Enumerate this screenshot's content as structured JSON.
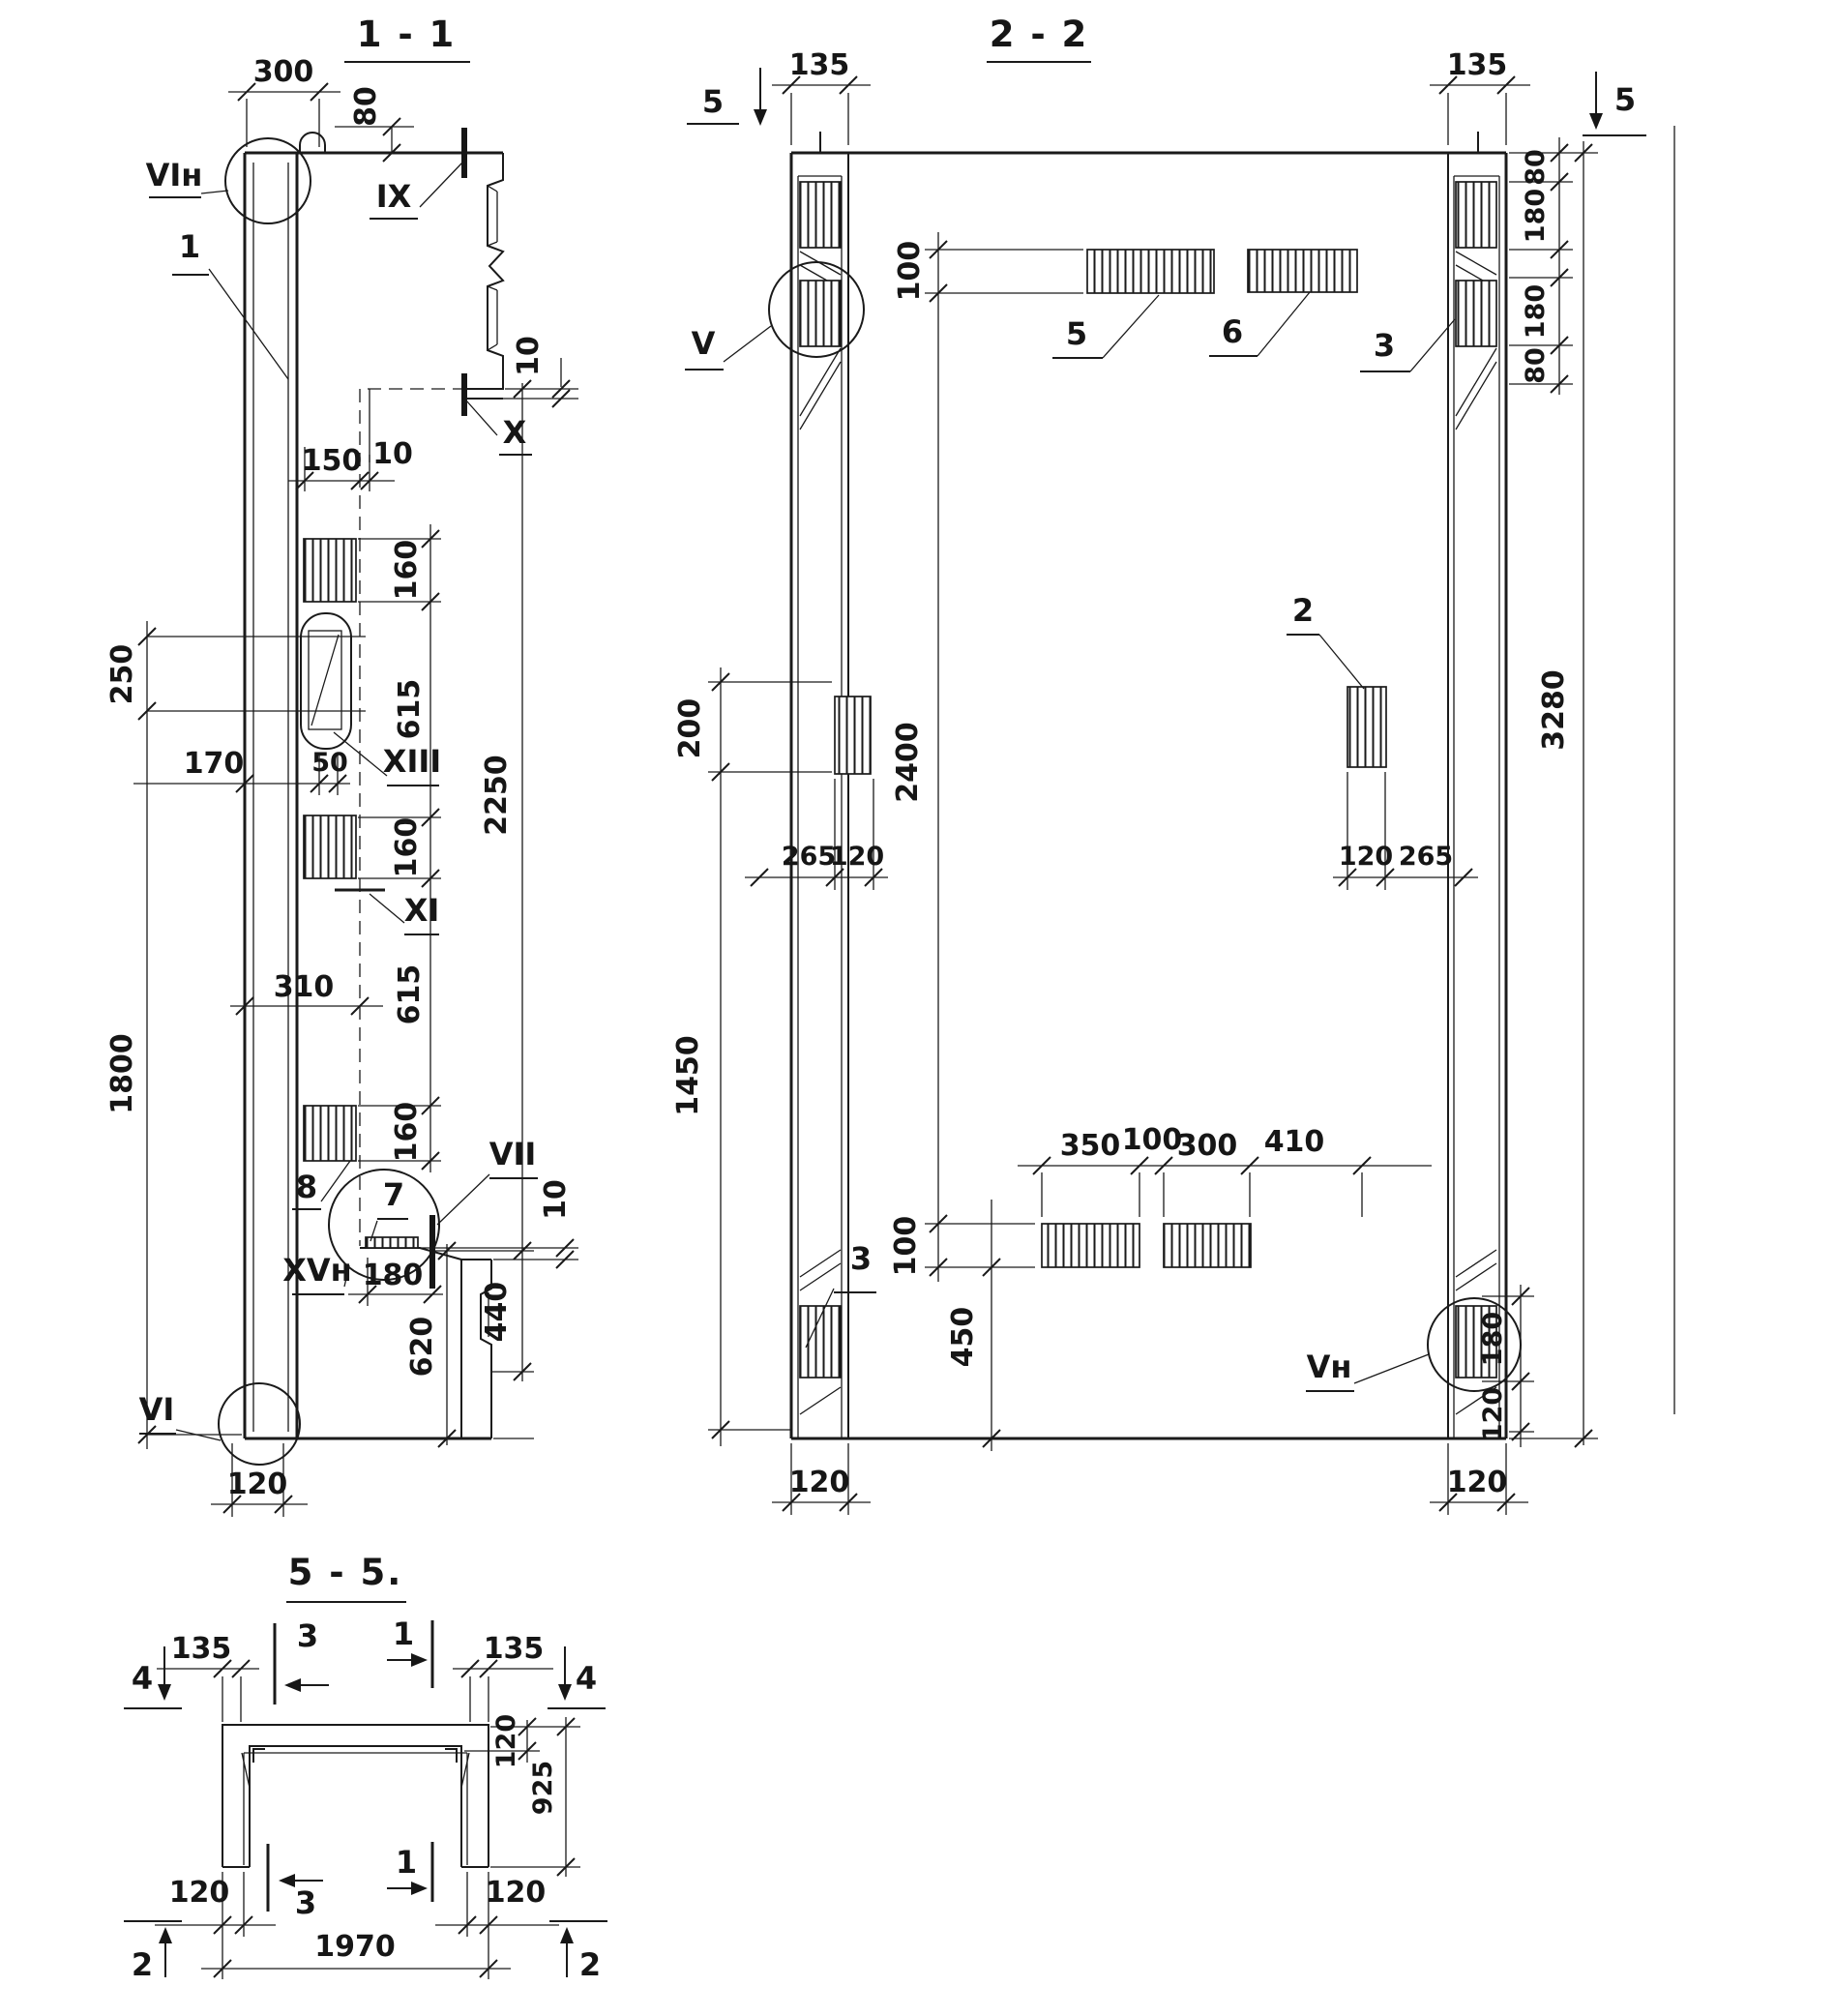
{
  "s11": {
    "title": "1 - 1",
    "dim_300": "300",
    "dim_80": "80",
    "dim_10_top": "10",
    "dim_150": "150",
    "dim_10_mid": "10",
    "dim_160_a": "160",
    "dim_615_a": "615",
    "dim_160_b": "160",
    "dim_615_b": "615",
    "dim_160_c": "160",
    "dim_2250": "2250",
    "dim_440": "440",
    "dim_620": "620",
    "dim_250": "250",
    "dim_1800": "1800",
    "dim_170": "170",
    "dim_50": "50",
    "dim_310": "310",
    "dim_180": "180",
    "dim_10_bottom": "10",
    "dim_120": "120",
    "label_vi_n": "VIн",
    "label_1": "1",
    "label_ix": "IX",
    "label_x": "X",
    "label_xiii": "XIII",
    "label_xi": "XI",
    "label_8": "8",
    "label_7": "7",
    "label_vii": "VII",
    "label_xv_n": "XVн",
    "label_vi": "VI"
  },
  "s22": {
    "title": "2 - 2",
    "marker_5_left": "5",
    "marker_5_right": "5",
    "dim_135_left": "135",
    "dim_135_right": "135",
    "dim_100_top": "100",
    "dim_2400": "2400",
    "dim_100_bottom": "100",
    "dim_450": "450",
    "dim_200": "200",
    "dim_1450": "1450",
    "dim_265_left": "265",
    "dim_120_left_mid": "120",
    "dim_120_right_mid": "120",
    "dim_265_right": "265",
    "dim_350": "350",
    "dim_100_bars": "100",
    "dim_300": "300",
    "dim_410": "410",
    "dim_80_a": "80",
    "dim_180_a": "180",
    "dim_180_b": "180",
    "dim_80_b": "80",
    "dim_3280": "3280",
    "dim_180_right": "180",
    "dim_120_right": "120",
    "dim_120_col_left": "120",
    "dim_120_col_right": "120",
    "label_v": "V",
    "label_v_n": "Vн",
    "label_2": "2",
    "label_3_top": "3",
    "label_3_bottom": "3",
    "label_5": "5",
    "label_6": "6"
  },
  "s55": {
    "title": "5 - 5.",
    "marker_4_left": "4",
    "marker_4_right": "4",
    "marker_3_top": "3",
    "marker_1_top": "1",
    "marker_3_bottom": "3",
    "marker_1_bottom": "1",
    "marker_2_left": "2",
    "marker_2_right": "2",
    "dim_135_left": "135",
    "dim_135_right": "135",
    "dim_120_wall": "120",
    "dim_925": "925",
    "dim_120_left": "120",
    "dim_120_right": "120",
    "dim_1970": "1970"
  }
}
